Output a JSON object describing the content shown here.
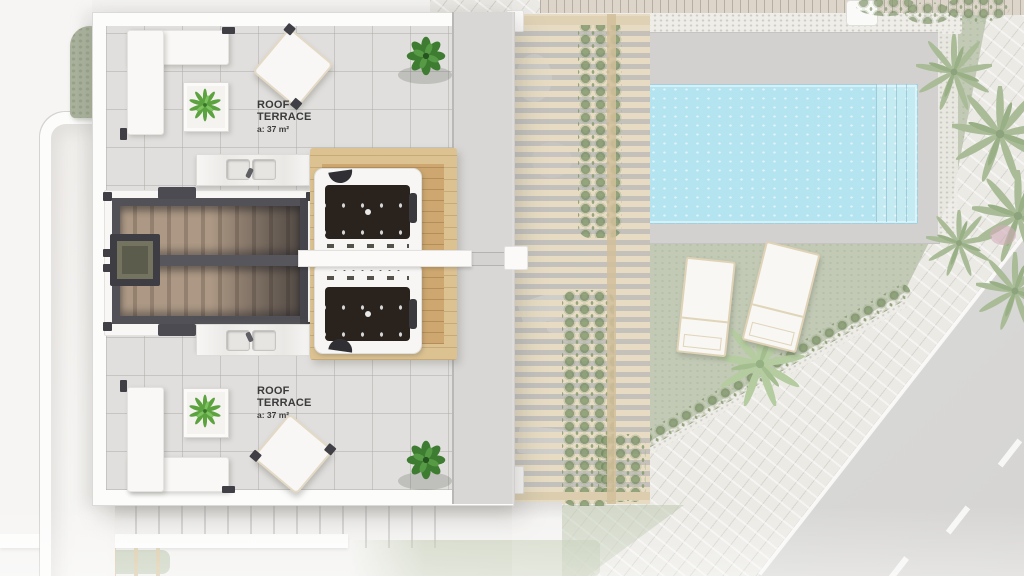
{
  "labels": {
    "terrace_upper": {
      "line1": "ROOF",
      "line2": "TERRACE",
      "area": "a: 37 m²"
    },
    "terrace_lower": {
      "line1": "ROOF",
      "line2": "TERRACE",
      "area": "a: 37 m²"
    }
  },
  "colors": {
    "pool_water": "#a9e0ee",
    "pool_deck": "#cbcac8",
    "grass": "#b9c2ab",
    "pergola_slat": "#e4d7ba",
    "wood_deck_outer": "#dcc291",
    "wood_deck_inner": "#cda76f",
    "stair_steps": "#ac9884",
    "stair_walls": "#515157",
    "jacuzzi_tub": "#2a221c",
    "terrace_floor": "#e0dfdd",
    "building_white": "#fcfcfb",
    "road": "#d4d3d1",
    "sidewalk": "#e9e7e2",
    "hedge_green": "#a9b29c",
    "label_text": "#3b3b3b"
  }
}
